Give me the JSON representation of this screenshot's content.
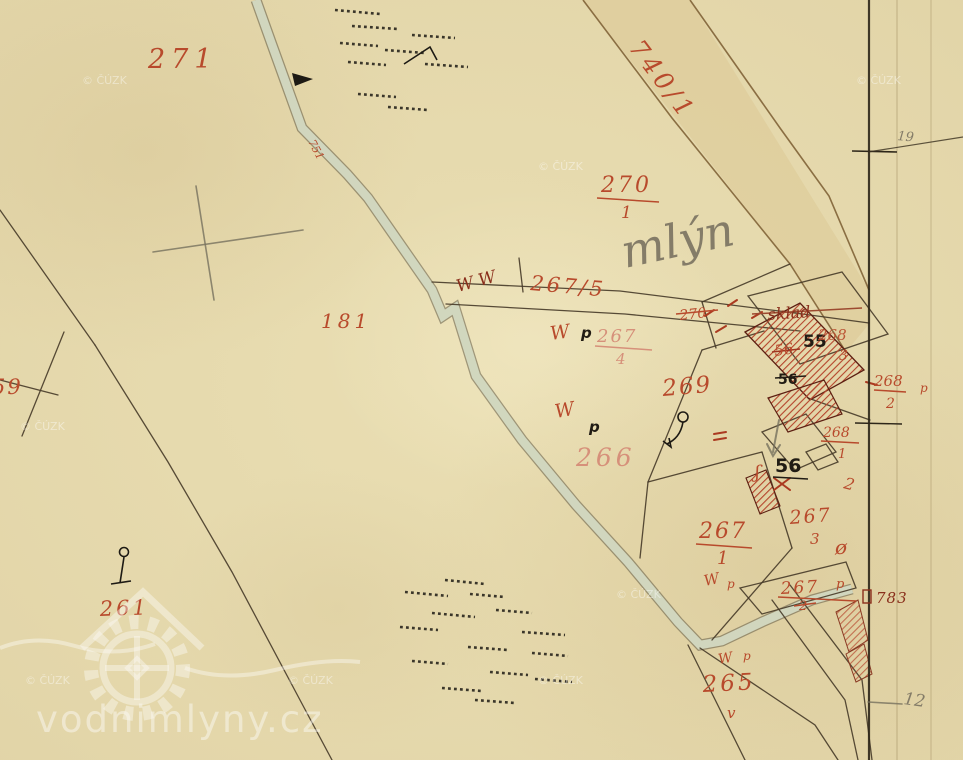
{
  "palette": {
    "paper": "#e8dcb2",
    "red_ink": "#b84a2c",
    "faded_red": "#d6907a",
    "dark_red": "#8a2f1c",
    "black_ink": "#211c14",
    "pencil": "#847c68",
    "stream_fill": "#d4dac2",
    "road_fill": "#ddc996"
  },
  "watermarks": {
    "copyright": "© ČÚZK",
    "site": "vodnimlyny.cz"
  },
  "margin": {
    "sheet_top": "19",
    "sheet_bottom": "12"
  },
  "pencil_note": "mlýn",
  "labels": [
    {
      "text": "271"
    },
    {
      "text": "740/1"
    },
    {
      "text": "270"
    },
    {
      "text": "1"
    },
    {
      "text": "mlýn"
    },
    {
      "text": "267/5"
    },
    {
      "text": "W"
    },
    {
      "text": "W"
    },
    {
      "text": "W"
    },
    {
      "text": "p"
    },
    {
      "text": "267"
    },
    {
      "text": "4"
    },
    {
      "text": "270"
    },
    {
      "text": "181"
    },
    {
      "text": "269"
    },
    {
      "text": "W"
    },
    {
      "text": "p"
    },
    {
      "text": "266"
    },
    {
      "text": "sklad"
    },
    {
      "text": "55"
    },
    {
      "text": "56"
    },
    {
      "text": "56"
    },
    {
      "text": "268"
    },
    {
      "text": "3"
    },
    {
      "text": "268"
    },
    {
      "text": "2"
    },
    {
      "text": "268"
    },
    {
      "text": "1"
    },
    {
      "text": "2"
    },
    {
      "text": "56"
    },
    {
      "text": "ʃ"
    },
    {
      "text": "267"
    },
    {
      "text": "1"
    },
    {
      "text": "267"
    },
    {
      "text": "3"
    },
    {
      "text": "ø"
    },
    {
      "text": "267"
    },
    {
      "text": "p"
    },
    {
      "text": "2"
    },
    {
      "text": "W"
    },
    {
      "text": "p"
    },
    {
      "text": "265"
    },
    {
      "text": "W"
    },
    {
      "text": "p"
    },
    {
      "text": "261"
    },
    {
      "text": "59"
    },
    {
      "text": "751"
    },
    {
      "text": "783"
    },
    {
      "text": "19"
    },
    {
      "text": "12"
    },
    {
      "text": "v"
    },
    {
      "text": "p"
    }
  ]
}
